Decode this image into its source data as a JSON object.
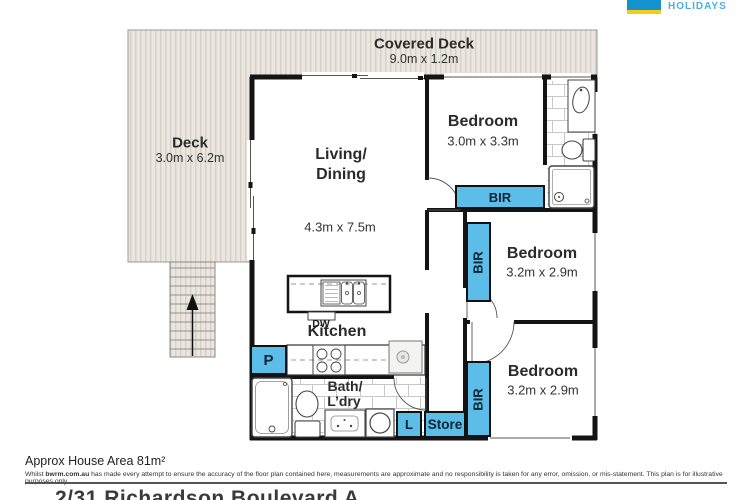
{
  "logo": {
    "brand": "HOLIDAYS"
  },
  "rooms": {
    "covered_deck": {
      "name": "Covered Deck",
      "dims": "9.0m x 1.2m"
    },
    "deck": {
      "name": "Deck",
      "dims": "3.0m x 6.2m"
    },
    "living": {
      "line1": "Living/",
      "line2": "Dining",
      "dims": "4.3m x 7.5m"
    },
    "bedroom1": {
      "name": "Bedroom",
      "dims": "3.0m x 3.3m"
    },
    "bedroom2": {
      "name": "Bedroom",
      "dims": "3.2m x 2.9m"
    },
    "bedroom3": {
      "name": "Bedroom",
      "dims": "3.2m x 2.9m"
    },
    "kitchen": {
      "name": "Kitchen",
      "dishwasher": "DW",
      "pantry": "P"
    },
    "bath": {
      "line1": "Bath/",
      "line2": "L’dry"
    },
    "robe": "BIR",
    "linen": "L",
    "store": "Store"
  },
  "footer": {
    "area": "Approx House Area 81m²",
    "disclaimer_prefix": "Whilst ",
    "disclaimer_site": "bwrm.com.au",
    "disclaimer_rest": " has made every attempt to ensure the accuracy of the floor plan contained here, measurements are approximate and no responsibility is taken for any error, omission, or mis-statement. This plan is for illustrative purposes only.",
    "address": "2/31 Richardson Boulevard A"
  },
  "colors": {
    "accent": "#5BBDE8",
    "wall": "#141414",
    "deck-fill": "#EBE7E0",
    "deck-stripe": "#D6D0C6",
    "logo-blue": "#1492CE",
    "logo-yellow": "#F2CE16",
    "logo-text": "#4BAFD9"
  }
}
